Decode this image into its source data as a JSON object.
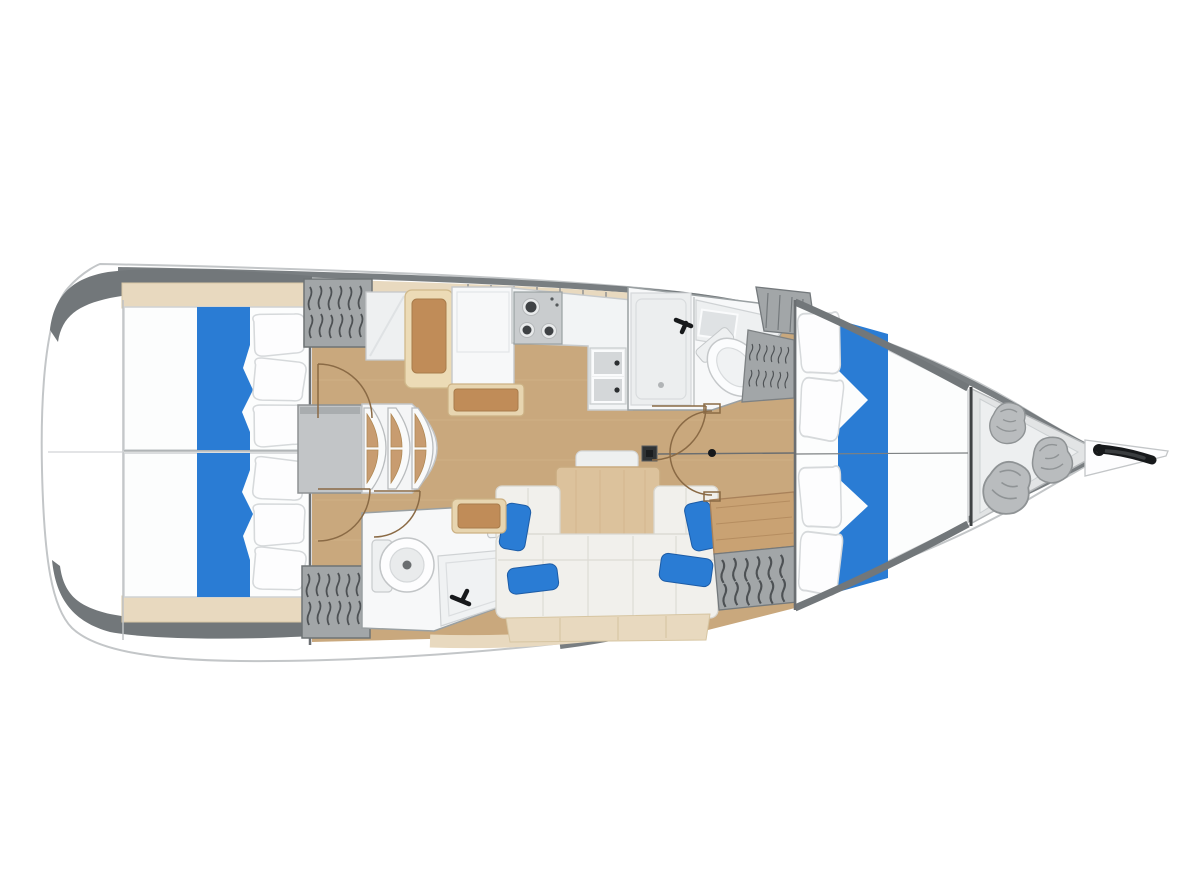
{
  "diagram": {
    "type": "yacht-interior-floor-plan",
    "view": "top-down-deck-plan",
    "orientation": "bow-right",
    "areas": [
      "swim-platform-transom",
      "aft-cabin-port-double-berth",
      "aft-cabin-starboard-double-berth",
      "hanging-locker-port-aft",
      "hanging-locker-starboard-aft",
      "companionway-steps",
      "engine-compartment",
      "nav-station-seat",
      "chart-table",
      "galley-stove-3-burner",
      "galley-double-sink",
      "forward-head-shower",
      "forward-head-sink",
      "forward-head-toilet",
      "forward-head-wardrobe",
      "aft-head-toilet",
      "aft-head-sink",
      "aft-head-shower",
      "saloon-dining-table",
      "saloon-u-sofa",
      "saloon-blue-cushions",
      "saloon-side-bench",
      "wardrobe-forward",
      "forward-cabin-v-berth",
      "sail-locker-storage-bags",
      "bow-anchor-roller",
      "mast-step",
      "cabin-door-swings"
    ]
  },
  "colors": {
    "berth_blue": "#2a7cd4",
    "floor_wood": "#c9a87d",
    "trim_beige": "#e8d9bf",
    "table_wood": "#dcc29c",
    "seat_tan": "#c08c58",
    "locker_gray": "#a2a6a8",
    "hanger_dark": "#4d5154",
    "hull_gray": "#72777a",
    "bag_gray": "#b9bcbe",
    "door_brown": "#8a6a45",
    "hardware_black": "#17191b"
  }
}
